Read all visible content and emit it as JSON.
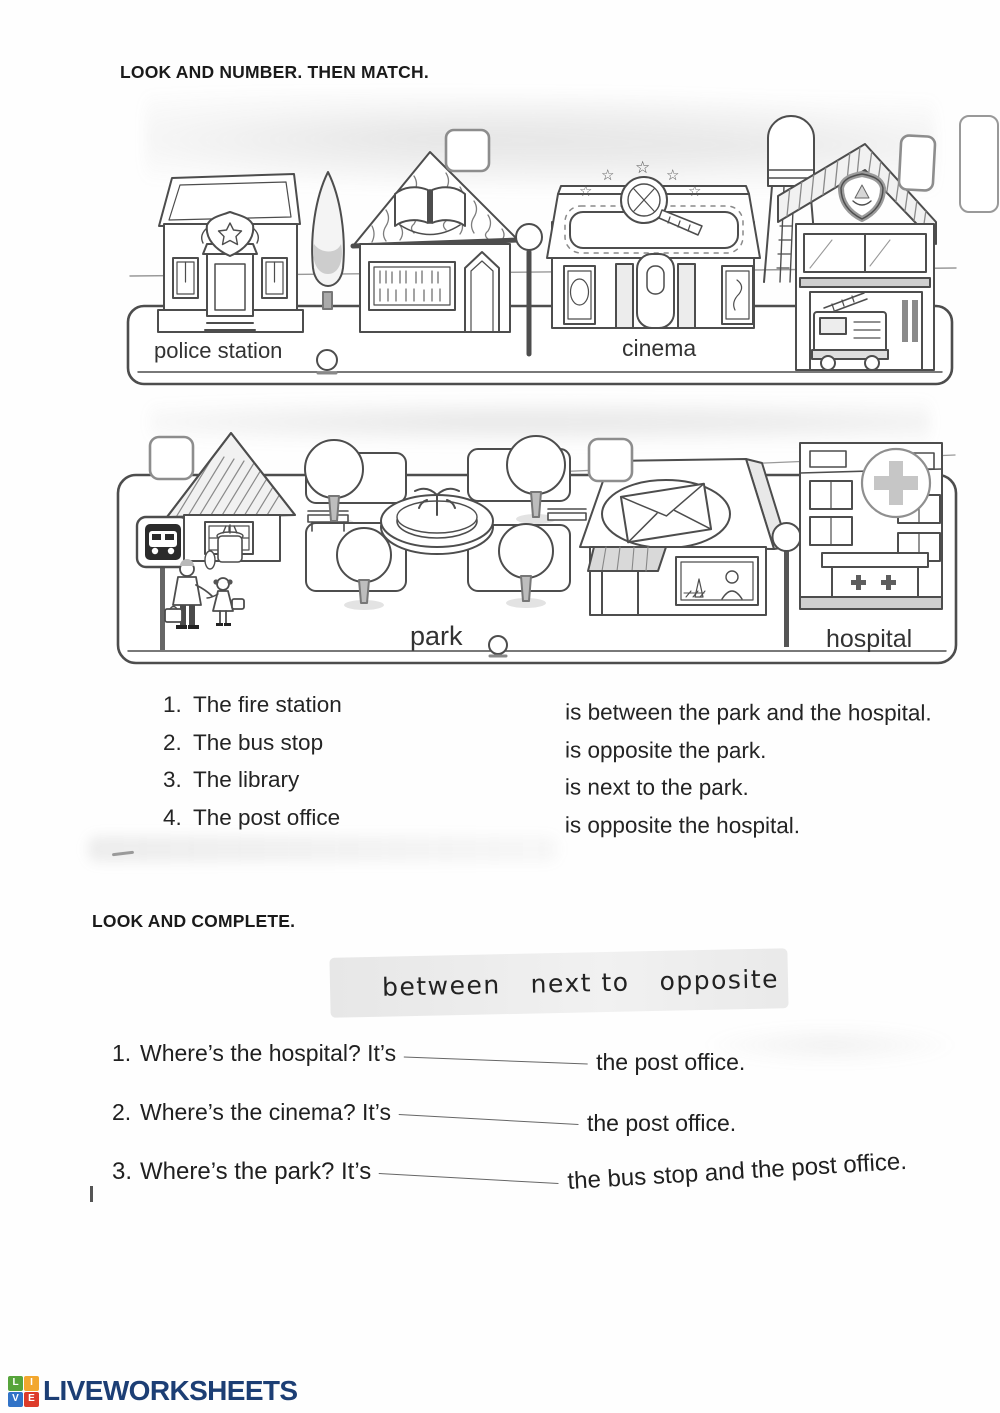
{
  "headings": {
    "match_title": "LOOK AND NUMBER. THEN MATCH.",
    "complete_title": "LOOK AND COMPLETE."
  },
  "scene_street1": {
    "labels": {
      "police_station": "police station",
      "cinema": "cinema"
    }
  },
  "scene_street2": {
    "labels": {
      "park": "park",
      "hospital": "hospital"
    }
  },
  "matching": {
    "items": [
      {
        "num": "1.",
        "label": "The fire station"
      },
      {
        "num": "2.",
        "label": "The bus stop"
      },
      {
        "num": "3.",
        "label": "The library"
      },
      {
        "num": "4.",
        "label": "The post office"
      }
    ],
    "endings": [
      "is between the park and the hospital.",
      "is opposite the park.",
      "is next to the park.",
      "is opposite the hospital."
    ]
  },
  "word_bank": {
    "words": [
      "between",
      "next to",
      "opposite"
    ]
  },
  "complete": {
    "questions": [
      {
        "num": "1.",
        "prompt": "Where’s the hospital? It’s",
        "after": "the post office."
      },
      {
        "num": "2.",
        "prompt": "Where’s the cinema? It’s",
        "after": "the post office."
      },
      {
        "num": "3.",
        "prompt": "Where’s the park? It’s",
        "after": "the bus stop and the post office."
      }
    ]
  },
  "footer": {
    "brand": "LIVEWORKSHEETS",
    "logo_tiles": [
      {
        "letter": "L",
        "color": "#56a43b"
      },
      {
        "letter": "I",
        "color": "#f2a72e"
      },
      {
        "letter": "V",
        "color": "#3173c7"
      },
      {
        "letter": "E",
        "color": "#dd3b2a"
      }
    ]
  }
}
